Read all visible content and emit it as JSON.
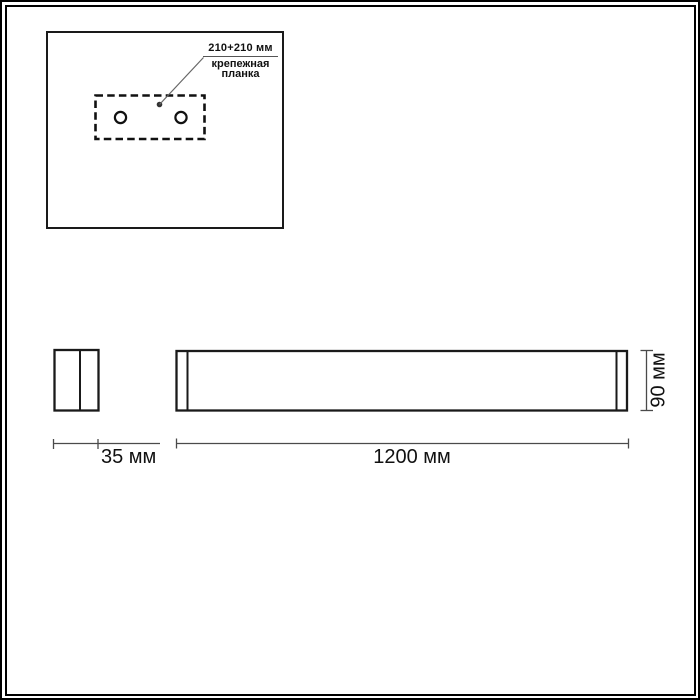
{
  "diagram": {
    "annotation": {
      "dimension": "210+210 мм",
      "caption_line1": "крепежная",
      "caption_line2": "планка"
    },
    "dimensions": {
      "depth": "35 мм",
      "length": "1200 мм",
      "height": "90 мм"
    },
    "colors": {
      "line": "#1a1a1a",
      "dim_line": "#4a4a4a",
      "background": "#ffffff"
    }
  }
}
